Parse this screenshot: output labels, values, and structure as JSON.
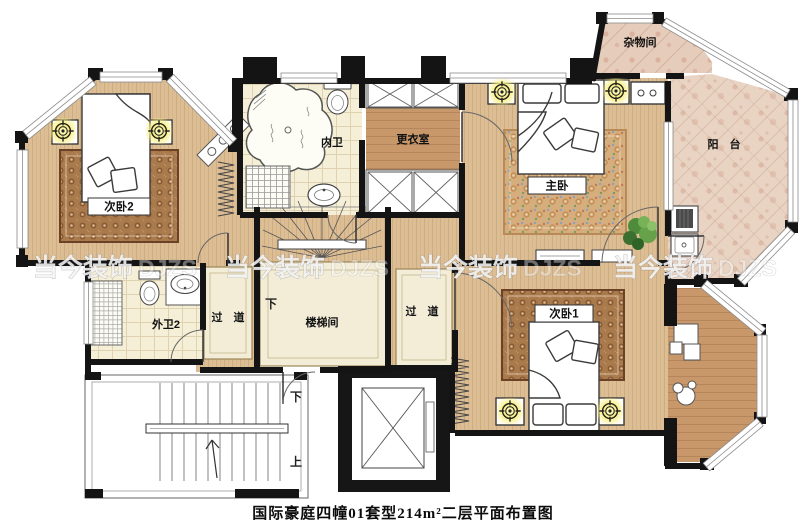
{
  "caption": "国际豪庭四幢01套型214m²二层平面布置图",
  "watermark": {
    "brand": "当今装饰",
    "suffix": "DJZS"
  },
  "rooms": {
    "bedroom2": "次卧2",
    "inner_bath": "内卫",
    "dressing": "更衣室",
    "master": "主卧",
    "storage": "杂物间",
    "balcony": "阳　台",
    "outer_bath2": "外卫2",
    "corridor": "过　道",
    "stairwell": "楼梯间",
    "bedroom1": "次卧1"
  },
  "labels": {
    "down": "下",
    "up": "上"
  },
  "icons": {
    "lamp": "ceiling-lamp-icon",
    "plant": "potted-plant-icon",
    "elevator": "elevator-shaft-icon"
  },
  "palette": {
    "wood_floor": "#dcbd94",
    "dark_wood": "#c9986a",
    "marble": "#e9d4c4",
    "tile": "#f6efd8",
    "corridor_fill": "#f3edd8",
    "wall": "#141414",
    "lamp_glow": "#f9ef80"
  }
}
